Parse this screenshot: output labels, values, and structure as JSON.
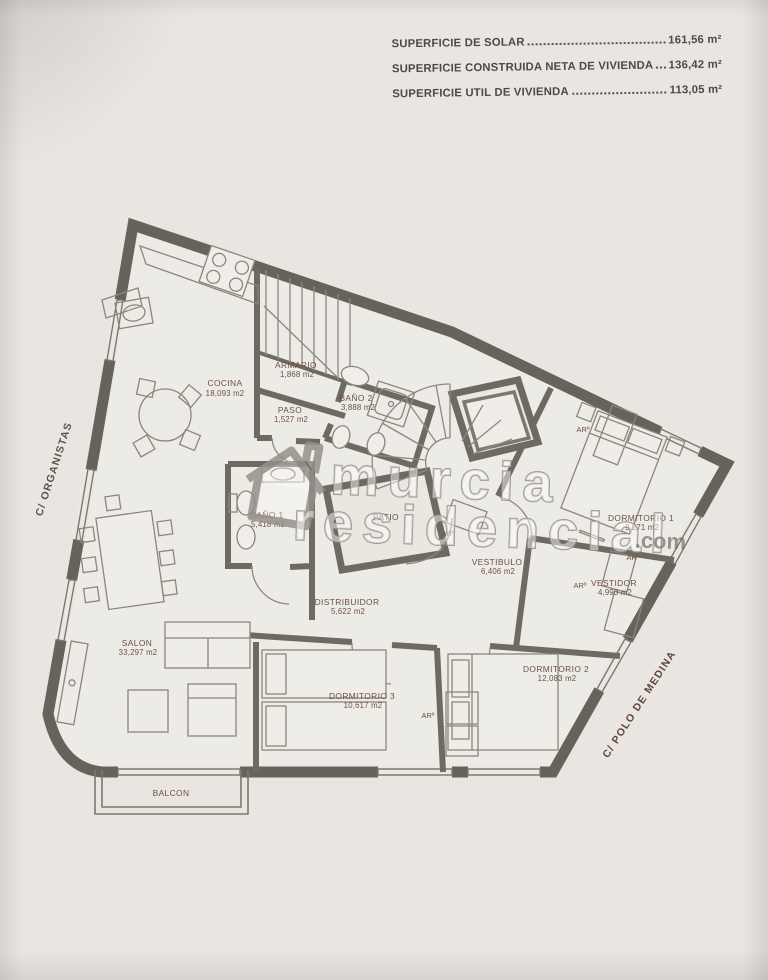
{
  "header": {
    "lines": [
      {
        "label": "SUPERFICIE DE SOLAR",
        "value": "161,56 m²"
      },
      {
        "label": "SUPERFICIE CONSTRUIDA NETA DE VIVIENDA",
        "value": "136,42 m²"
      },
      {
        "label": "SUPERFICIE UTIL DE VIVIENDA",
        "value": "113,05 m²"
      }
    ]
  },
  "streets": {
    "left": "C/ ORGANISTAS",
    "right": "C/ POLO DE MEDINA"
  },
  "watermark": {
    "word1": "murcia",
    "word2": "residencial",
    "suffix": ".com",
    "icon": "house-icon"
  },
  "labels": {
    "closet": "ARº"
  },
  "rooms": {
    "cocina": {
      "name": "COCINA",
      "area": "18,093 m2"
    },
    "armario": {
      "name": "ARMARIO",
      "area": "1,868 m2"
    },
    "paso": {
      "name": "PASO",
      "area": "1,527 m2"
    },
    "bano2": {
      "name": "BAÑO 2",
      "area": "3,888 m2"
    },
    "bano1": {
      "name": "BAÑO 1",
      "area": "5,418 m2"
    },
    "patio": {
      "name": "PATIO",
      "area": ""
    },
    "distribuidor": {
      "name": "DISTRIBUIDOR",
      "area": "5,622 m2"
    },
    "vestibulo": {
      "name": "VESTIBULO",
      "area": "6,406 m2"
    },
    "dormitorio1": {
      "name": "DORMITORIO 1",
      "area": "9,271 m2"
    },
    "vestidor": {
      "name": "VESTIDOR",
      "area": "4,993 m2"
    },
    "dormitorio2": {
      "name": "DORMITORIO 2",
      "area": "12,083 m2"
    },
    "dormitorio3": {
      "name": "DORMITORIO 3",
      "area": "10,617 m2"
    },
    "salon": {
      "name": "SALON",
      "area": "33,297 m2"
    },
    "balcon": {
      "name": "BALCON",
      "area": ""
    }
  }
}
